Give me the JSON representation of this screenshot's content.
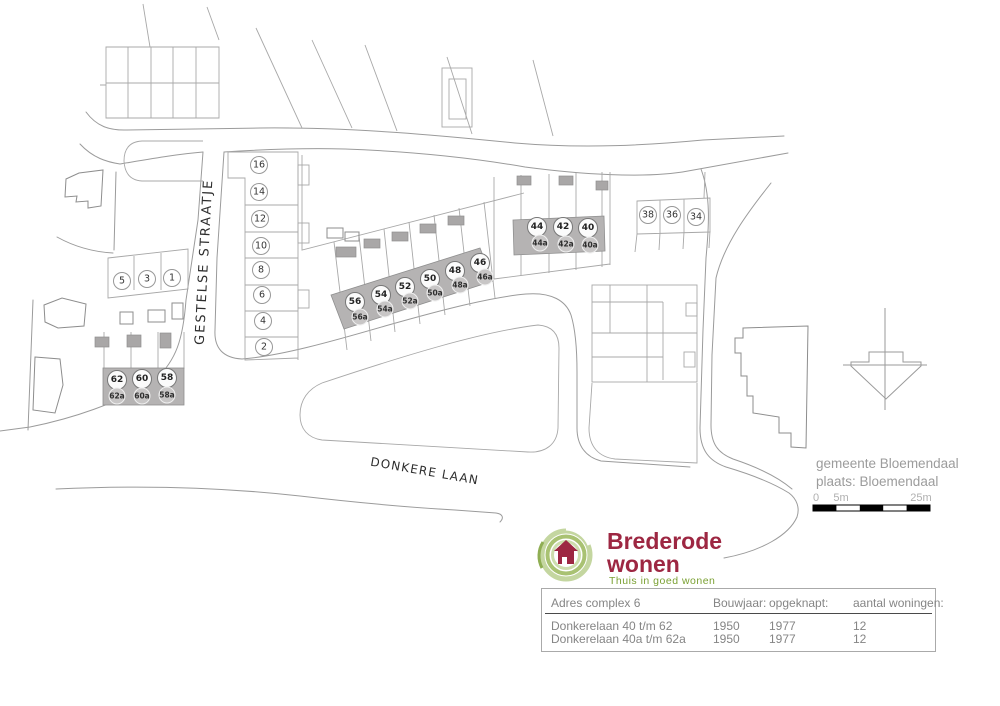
{
  "map": {
    "street_gestelse": "GESTELSE STRAATJE",
    "street_donkere": "DONKERE LAAN",
    "gestelse_parcels": [
      "16",
      "14",
      "12",
      "10",
      "8",
      "6",
      "4",
      "2"
    ],
    "north_parcels": [
      "5",
      "3",
      "1"
    ],
    "east_parcels": [
      "38",
      "36",
      "34"
    ],
    "houses_left_main": [
      "62",
      "60",
      "58"
    ],
    "houses_left_sub": [
      "62a",
      "60a",
      "58a"
    ],
    "houses_middle_main": [
      "56",
      "54",
      "52",
      "50",
      "48",
      "46"
    ],
    "houses_middle_sub": [
      "56a",
      "54a",
      "52a",
      "50a",
      "48a",
      "46a"
    ],
    "houses_right_main": [
      "44",
      "42",
      "40"
    ],
    "houses_right_sub": [
      "44a",
      "42a",
      "40a"
    ],
    "municipality_line1": "gemeente Bloemendaal",
    "municipality_line2": "plaats: Bloemendaal",
    "scale_ticks": [
      "0",
      "5m",
      "25m"
    ]
  },
  "logo": {
    "line1": "Brederode",
    "line2": "wonen",
    "tagline": "Thuis in goed wonen"
  },
  "colors": {
    "brand_red": "#9d2742",
    "brand_green": "#7aa032",
    "block_gray": "#b5b3b3"
  },
  "table": {
    "headers": [
      "Adres complex 6",
      "Bouwjaar:",
      "opgeknapt:",
      "aantal woningen:"
    ],
    "rows": [
      [
        "Donkerelaan 40 t/m 62",
        "1950",
        "1977",
        "12"
      ],
      [
        "Donkerelaan 40a t/m 62a",
        "1950",
        "1977",
        "12"
      ]
    ]
  }
}
